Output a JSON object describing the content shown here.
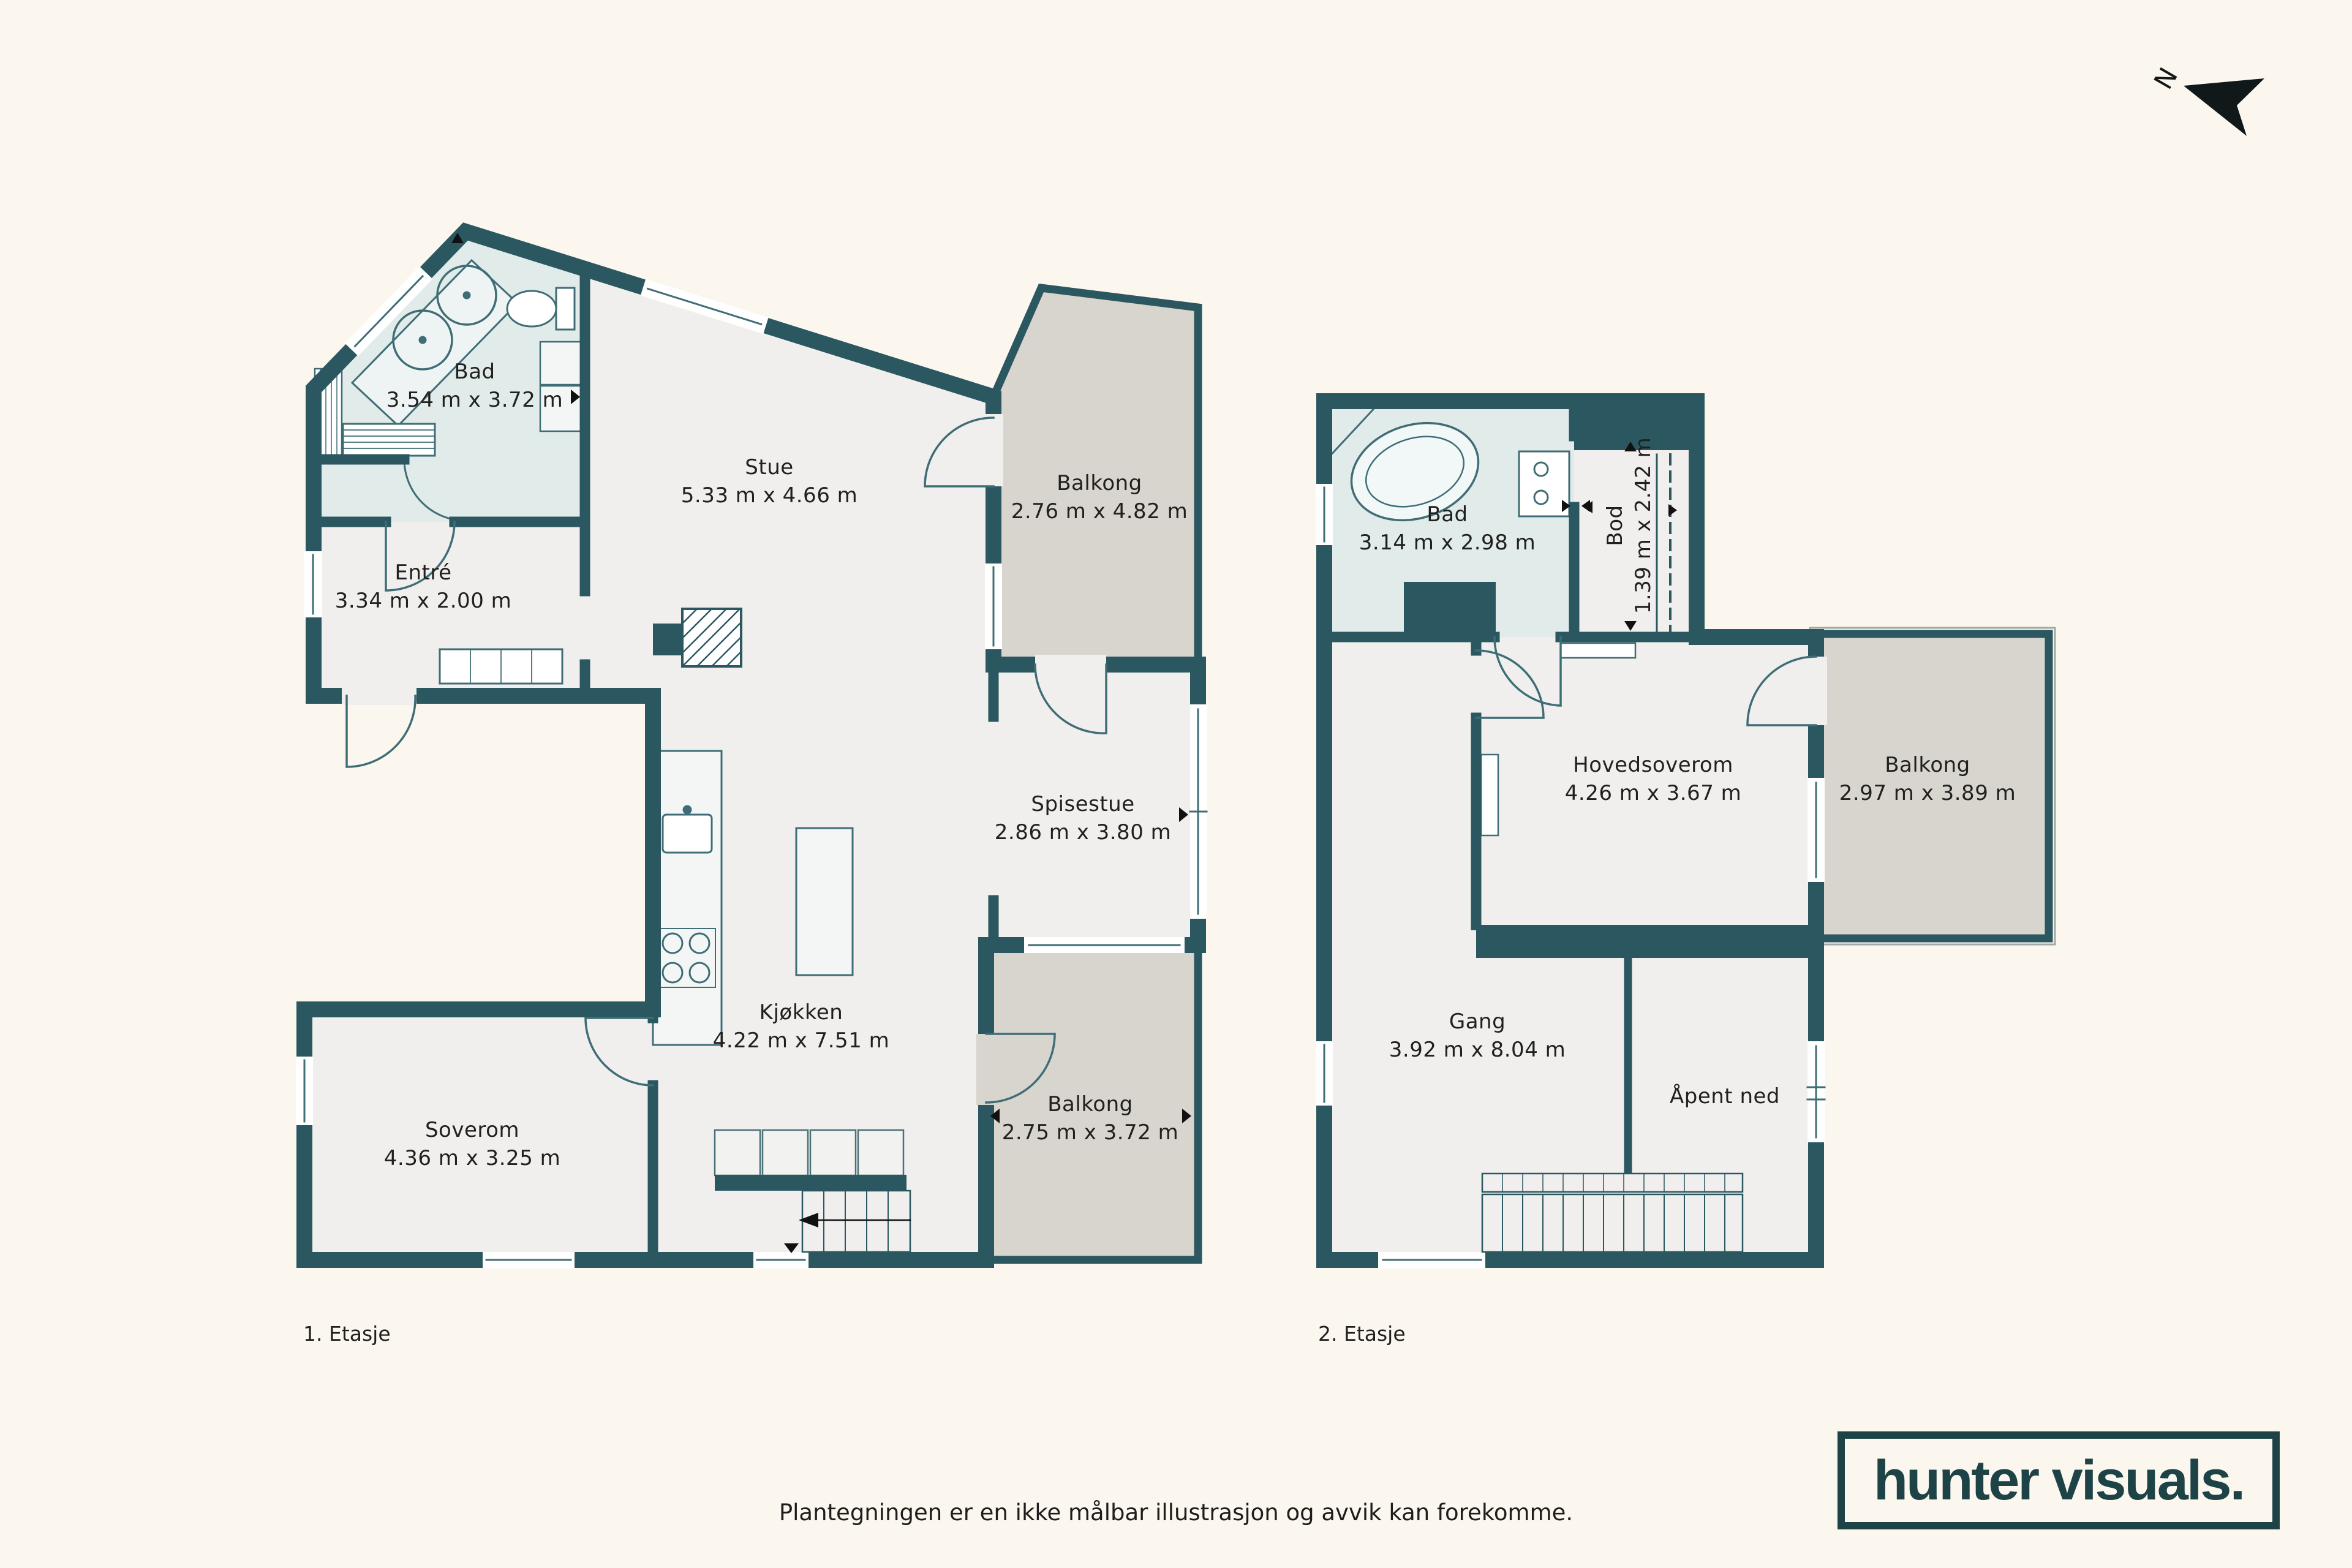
{
  "page": {
    "background_color": "#fbf7ef",
    "disclaimer": "Plantegningen er en ikke målbar illustrasjon og avvik kan forekomme."
  },
  "compass": {
    "north_label": "N"
  },
  "branding": {
    "logo_text": "hunter visuals."
  },
  "palette": {
    "wall": "#2a5760",
    "room_floor": "#f0efed",
    "wet_room_floor": "#e0ebea",
    "balcony_floor": "#d8d4ce",
    "fixture_line": "#3f6d76",
    "label_text": "#20201e",
    "logo": "#1e4347",
    "background": "#fbf7ef"
  },
  "floor1": {
    "label": "1. Etasje",
    "rooms": {
      "bad": {
        "name": "Bad",
        "dimensions": "3.54 m x 3.72 m"
      },
      "stue": {
        "name": "Stue",
        "dimensions": "5.33 m x 4.66 m"
      },
      "balkong_nord": {
        "name": "Balkong",
        "dimensions": "2.76 m x 4.82 m"
      },
      "entre": {
        "name": "Entré",
        "dimensions": "3.34 m x 2.00 m"
      },
      "spisestue": {
        "name": "Spisestue",
        "dimensions": "2.86 m x 3.80 m"
      },
      "kjokken": {
        "name": "Kjøkken",
        "dimensions": "4.22 m x 7.51 m"
      },
      "soverom": {
        "name": "Soverom",
        "dimensions": "4.36 m x 3.25 m"
      },
      "balkong_sor": {
        "name": "Balkong",
        "dimensions": "2.75 m x 3.72 m"
      }
    }
  },
  "floor2": {
    "label": "2. Etasje",
    "rooms": {
      "bad": {
        "name": "Bad",
        "dimensions": "3.14 m x 2.98 m"
      },
      "bod": {
        "name": "Bod",
        "dimensions": "1.39 m x 2.42 m"
      },
      "hovedsoverom": {
        "name": "Hovedsoverom",
        "dimensions": "4.26 m x 3.67 m"
      },
      "balkong": {
        "name": "Balkong",
        "dimensions": "2.97 m x 3.89 m"
      },
      "gang": {
        "name": "Gang",
        "dimensions": "3.92 m x 8.04 m"
      },
      "apent_ned": {
        "name": "Åpent ned"
      }
    }
  }
}
